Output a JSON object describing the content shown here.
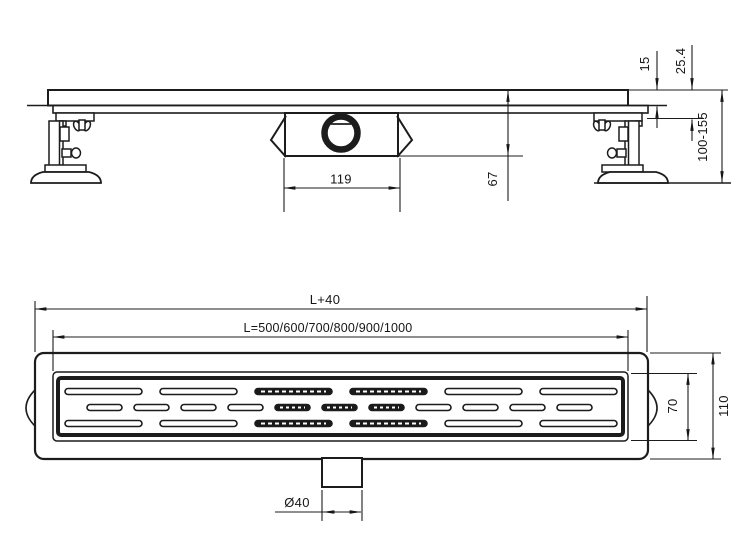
{
  "side_view": {
    "body_width": "119",
    "trap_height": "67",
    "rim_height": "15",
    "flange_depth": "25.4",
    "install_height_range": "100-155"
  },
  "plan_view": {
    "overall_length": "L+40",
    "channel_length": "L=500/600/700/800/900/1000",
    "grate_width": "70",
    "flange_width": "110",
    "outlet_diameter": "Ø40"
  }
}
